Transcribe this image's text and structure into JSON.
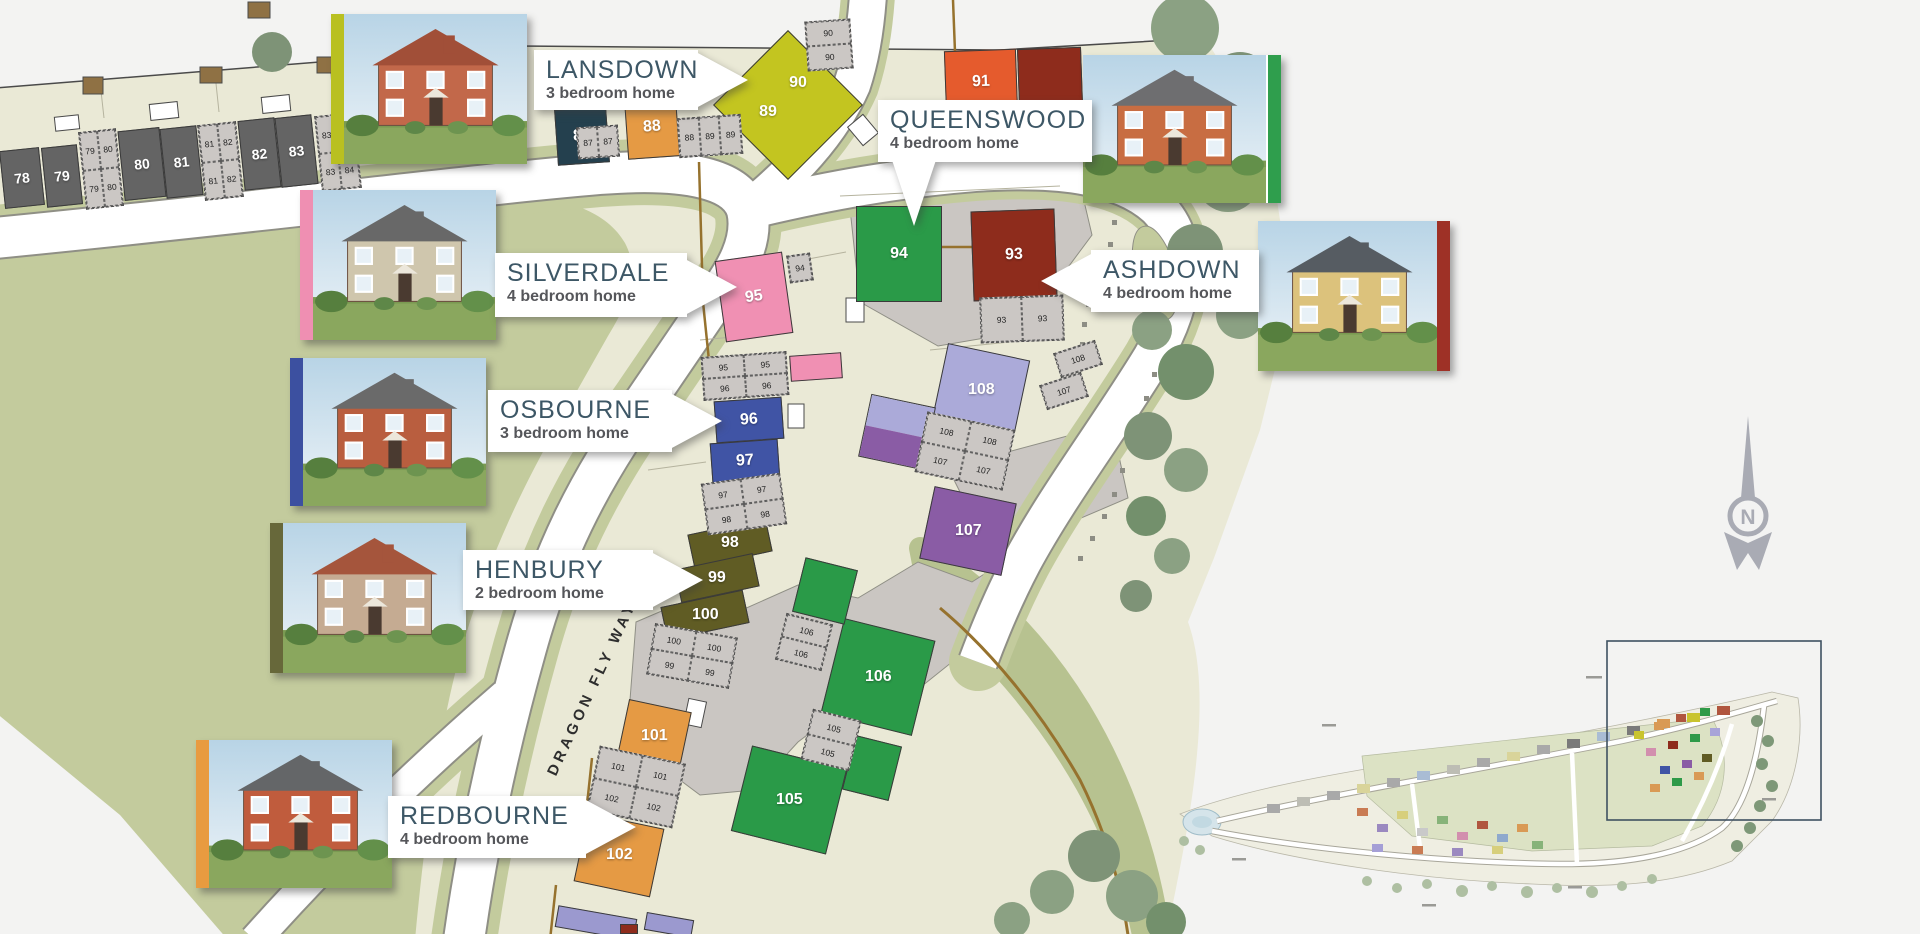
{
  "map": {
    "road_label": "DRAGON FLY WAY",
    "compass_letter": "N"
  },
  "house_types": [
    {
      "name": "LANSDOWN",
      "desc": "3 bedroom home",
      "stripe": "#b9c021"
    },
    {
      "name": "QUEENSWOOD",
      "desc": "4 bedroom home",
      "stripe": "#2f9e4d"
    },
    {
      "name": "SILVERDALE",
      "desc": "4 bedroom home",
      "stripe": "#ef8fb2"
    },
    {
      "name": "ASHDOWN",
      "desc": "4 bedroom home",
      "stripe": "#9e3126"
    },
    {
      "name": "OSBOURNE",
      "desc": "3 bedroom home",
      "stripe": "#3c50a0"
    },
    {
      "name": "HENBURY",
      "desc": "2 bedroom home",
      "stripe": "#67683a"
    },
    {
      "name": "REDBOURNE",
      "desc": "4 bedroom home",
      "stripe": "#e89b40"
    }
  ],
  "plots": {
    "78": "78",
    "79": "79",
    "80": "80",
    "81": "81",
    "82": "82",
    "83": "83",
    "84": "84",
    "87": "87",
    "88": "88",
    "89": "89",
    "90": "90",
    "91": "91",
    "93": "93",
    "94": "94",
    "95": "95",
    "96": "96",
    "97": "97",
    "98": "98",
    "99": "99",
    "100": "100",
    "101": "101",
    "102": "102",
    "105": "105",
    "106": "106",
    "107": "107",
    "108": "108"
  },
  "palette": {
    "existing": "#646464",
    "navy": "#24404e",
    "orange": "#e59a44",
    "lime": "#c3c520",
    "orangered": "#e55b2d",
    "maroon": "#8e2c1c",
    "green": "#2a9a48",
    "pink": "#f090b3",
    "blue": "#4054a5",
    "olive": "#605c24",
    "purple": "#8a5ca5",
    "lavender": "#abaad9",
    "lavender2": "#9b99cf"
  }
}
